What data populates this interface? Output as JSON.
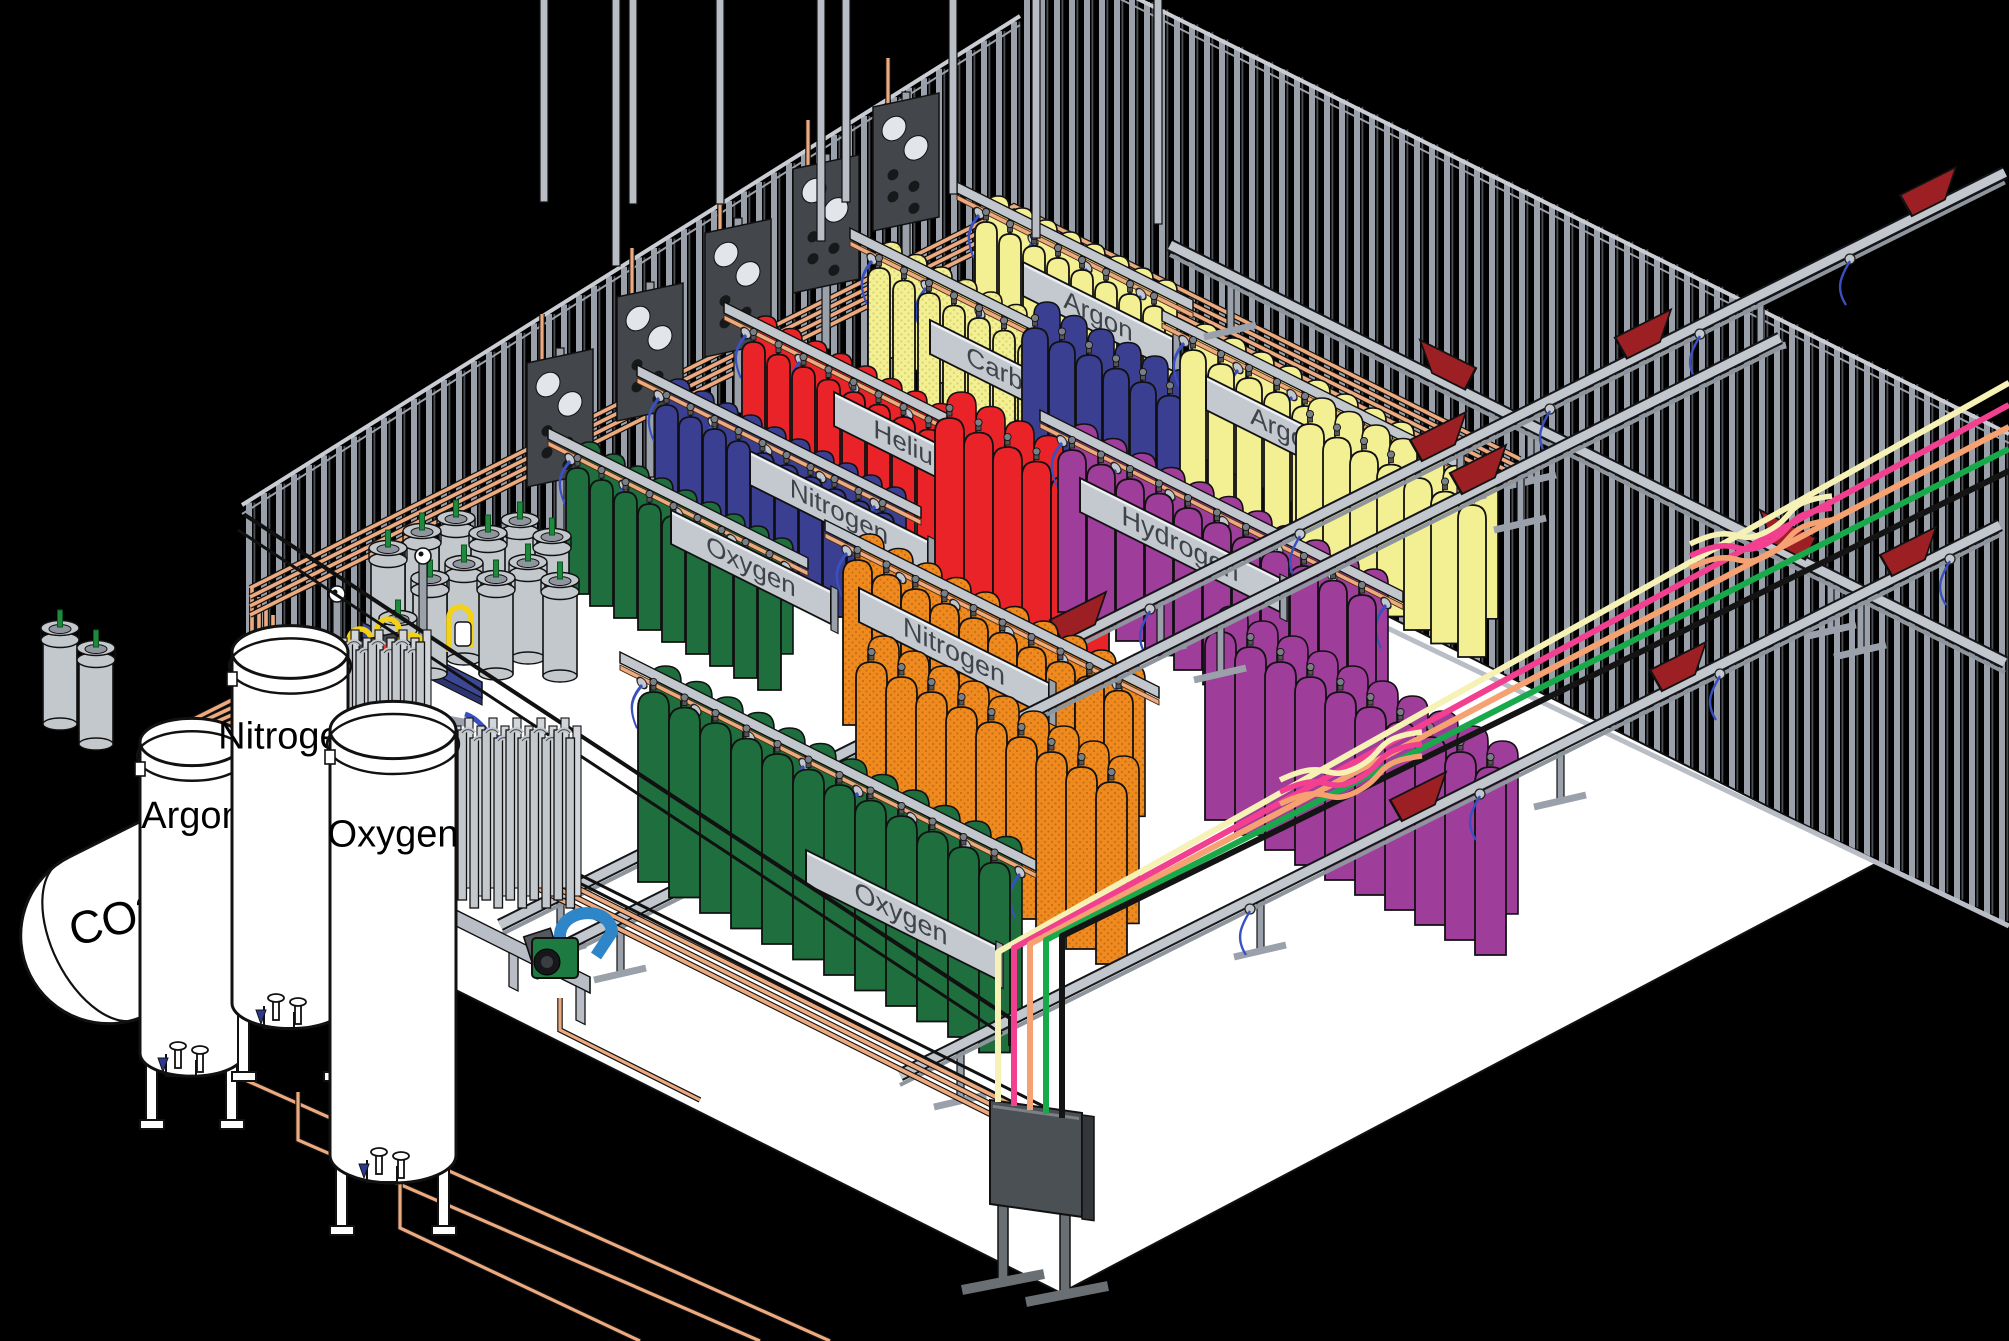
{
  "scene": {
    "width": 2009,
    "height": 1341,
    "bg": "#000000",
    "floor_color": "#ffffff",
    "stud_color": "#9aa1ab",
    "stud_dark": "#4b4f55",
    "plate_color": "#c9cdd3",
    "copper": "#edaa7e",
    "copper_dark": "#3a2414",
    "rail_gray": "#c2c7cd",
    "rail_edge": "#14161a",
    "carrier_red": "#9c2023",
    "sign_gray": "#c4c9d0",
    "sign_text": "#3f434a",
    "hose_blue": "#3a50c0",
    "panel_gray": "#4b5054",
    "metal_gray": "#c3c8cd",
    "pallet_blue": "#3c4896",
    "pump_green": "#1d7a40",
    "pump_blue": "#2e86c8"
  },
  "walls": {
    "left": {
      "poly": [
        [
          242,
          505
        ],
        [
          1020,
          16
        ],
        [
          1020,
          452
        ],
        [
          242,
          705
        ]
      ],
      "spacing": 15
    },
    "right": {
      "poly": [
        [
          1020,
          -60
        ],
        [
          2009,
          434
        ],
        [
          2009,
          926
        ],
        [
          1020,
          452
        ]
      ],
      "spacing": 15
    }
  },
  "floor": {
    "poly": [
      [
        242,
        705
      ],
      [
        1040,
        442
      ],
      [
        1879,
        862
      ],
      [
        1061,
        1293
      ],
      [
        242,
        883
      ]
    ]
  },
  "cylinder_colors": {
    "green": "#1e6e3e",
    "blue": "#3b3f91",
    "red": "#ea2328",
    "yellow": "#f3ef93",
    "purple": "#9f3d9b",
    "orange": "#ef8a1f"
  },
  "racks": [
    {
      "id": "rack-argon-back",
      "label": "Argon",
      "color": "yellow",
      "origin": [
        975,
        222
      ],
      "n": 8,
      "w": 22,
      "step": 24,
      "h": 118,
      "sign": {
        "dx": 48,
        "dy": 40,
        "w": 150,
        "fs": 26
      },
      "rail": true,
      "z": 210
    },
    {
      "id": "rack-co2-back",
      "label": "Carbon Dioxide",
      "color": "yellow",
      "dotted": true,
      "origin": [
        868,
        268
      ],
      "n": 13,
      "w": 22,
      "step": 25,
      "h": 126,
      "sign": {
        "dx": 62,
        "dy": 52,
        "w": 252,
        "fs": 26
      },
      "rail": true,
      "z": 260
    },
    {
      "id": "cluster-blue",
      "label": "",
      "color": "blue",
      "origin": [
        1022,
        328
      ],
      "n": 7,
      "w": 26,
      "step": 27,
      "h": 140,
      "z": 320
    },
    {
      "id": "rack-helium-back",
      "label": "Helium",
      "color": "red",
      "origin": [
        742,
        342
      ],
      "n": 10,
      "w": 23,
      "step": 25,
      "h": 128,
      "sign": {
        "dx": 92,
        "dy": 50,
        "w": 160,
        "fs": 26
      },
      "rail": true,
      "z": 335
    },
    {
      "id": "rack-argon-front",
      "label": "Argon",
      "color": "yellow",
      "origin": [
        1180,
        350
      ],
      "n": 9,
      "w": 26,
      "step": 28,
      "h": 148,
      "sign": {
        "dx": 26,
        "dy": 26,
        "w": 158,
        "fs": 26
      },
      "rail": true,
      "z": 345
    },
    {
      "id": "rack-nitrogen-back",
      "label": "Nitrogen",
      "color": "blue",
      "origin": [
        655,
        405
      ],
      "n": 10,
      "w": 23,
      "step": 24,
      "h": 128,
      "sign": {
        "dx": 95,
        "dy": 46,
        "w": 178,
        "fs": 26
      },
      "rail": true,
      "z": 400
    },
    {
      "id": "cluster-red",
      "label": "",
      "color": "red",
      "origin": [
        935,
        418
      ],
      "n": 6,
      "w": 29,
      "step": 29,
      "h": 165,
      "z": 415
    },
    {
      "id": "cluster-yellow",
      "label": "",
      "color": "yellow",
      "origin": [
        1296,
        424
      ],
      "n": 7,
      "w": 28,
      "step": 27,
      "h": 152,
      "z": 420
    },
    {
      "id": "rack-hydrogen-front",
      "label": "Hydrogen",
      "color": "purple",
      "origin": [
        1058,
        450
      ],
      "n": 11,
      "w": 28,
      "step": 29,
      "h": 162,
      "sign": {
        "dx": 22,
        "dy": 28,
        "w": 200,
        "fs": 27
      },
      "rail": true,
      "z": 450
    },
    {
      "id": "rack-oxygen-back",
      "label": "Oxygen",
      "color": "green",
      "origin": [
        566,
        468
      ],
      "n": 9,
      "w": 23,
      "step": 24,
      "h": 126,
      "sign": {
        "dx": 105,
        "dy": 42,
        "w": 160,
        "fs": 26
      },
      "rail": true,
      "z": 465
    },
    {
      "id": "rack-nitrogen-front",
      "label": "Nitrogen",
      "color": "orange",
      "dotted": true,
      "origin": [
        843,
        560
      ],
      "n": 10,
      "w": 29,
      "step": 29,
      "h": 165,
      "sign": {
        "dx": 16,
        "dy": 28,
        "w": 190,
        "fs": 27
      },
      "rail": true,
      "z": 560
    },
    {
      "id": "cluster-purple",
      "label": "",
      "color": "purple",
      "origin": [
        1205,
        632
      ],
      "n": 10,
      "w": 31,
      "step": 30,
      "h": 188,
      "z": 630
    },
    {
      "id": "cluster-orange",
      "label": "",
      "color": "orange",
      "dotted": true,
      "origin": [
        856,
        662
      ],
      "n": 9,
      "w": 31,
      "step": 30,
      "h": 182,
      "z": 660
    },
    {
      "id": "rack-oxygen-front",
      "label": "Oxygen",
      "color": "green",
      "origin": [
        638,
        692
      ],
      "n": 12,
      "w": 31,
      "step": 31,
      "h": 190,
      "sign": {
        "dx": 168,
        "dy": 158,
        "w": 190,
        "fs": 27
      },
      "rail": true,
      "z": 690
    }
  ],
  "conveyors": [
    {
      "slope": 0.5,
      "c": -340,
      "x1": 1170,
      "x2": 2005,
      "carriers": [
        1420,
        1760
      ],
      "z": 500
    },
    {
      "slope": -0.5,
      "c": 1175,
      "x1": 500,
      "x2": 2005,
      "carriers": [
        1050,
        1410,
        1615,
        1900
      ],
      "hangers": [
        1000,
        1150,
        1300,
        1550,
        1700,
        1850
      ],
      "z": 505
    },
    {
      "slope": -0.5,
      "c": 1228,
      "x1": 560,
      "x2": 1780,
      "carriers": [
        795,
        885,
        1450
      ],
      "z": 640
    },
    {
      "slope": -0.5,
      "c": 1525,
      "x1": 900,
      "x2": 2000,
      "carriers": [
        1390,
        1650,
        1880
      ],
      "hangers": [
        1250,
        1480,
        1720,
        1950
      ],
      "z": 1000
    }
  ],
  "manifold_panels": [
    [
      560,
      418
    ],
    [
      650,
      352
    ],
    [
      738,
      288
    ],
    [
      826,
      224
    ],
    [
      906,
      162
    ]
  ],
  "storage_tanks": [
    {
      "label": "Argon",
      "x": 140,
      "y": 742,
      "w": 104,
      "h": 330
    },
    {
      "label": "Nitrogen",
      "x": 232,
      "y": 652,
      "w": 116,
      "h": 372
    },
    {
      "label": "Oxygen",
      "x": 330,
      "y": 730,
      "w": 126,
      "h": 448
    }
  ],
  "co2_tank": {
    "label": "CO2",
    "tx": 30,
    "ty": 975,
    "len": 300,
    "r": 88
  },
  "vaporizers": [
    {
      "x": 332,
      "y": 650,
      "n": 8,
      "h": 116
    },
    {
      "x": 446,
      "y": 738,
      "n": 11,
      "h": 170
    }
  ],
  "dewars": [
    [
      60,
      640
    ],
    [
      96,
      660
    ],
    [
      388,
      560
    ],
    [
      422,
      543
    ],
    [
      456,
      530
    ],
    [
      488,
      545
    ],
    [
      520,
      532
    ],
    [
      552,
      548
    ],
    [
      430,
      590
    ],
    [
      464,
      575
    ],
    [
      496,
      590
    ],
    [
      528,
      574
    ],
    [
      560,
      592
    ],
    [
      398,
      630
    ]
  ],
  "pallet": [
    362,
    622
  ],
  "station": {
    "x": 337,
    "y": 648
  },
  "pump": {
    "x": 532,
    "y": 930
  },
  "panel": {
    "x": 990,
    "y": 1100,
    "w": 92,
    "h": 104
  },
  "hoses": {
    "colors": [
      "#f6f1b4",
      "#f23f90",
      "#f5a171",
      "#18a94b",
      "#141414"
    ],
    "x0": 998,
    "dx": 16,
    "top_y": 952,
    "end_x": 2009,
    "knots": [
      [
        1350,
        758
      ],
      [
        1760,
        522
      ]
    ]
  },
  "wall_pipes": {
    "n": 4,
    "gap": 9,
    "left_start": [
      250,
      588
    ],
    "corner": [
      1014,
      206
    ],
    "bridge_end": [
      1520,
      459
    ]
  }
}
